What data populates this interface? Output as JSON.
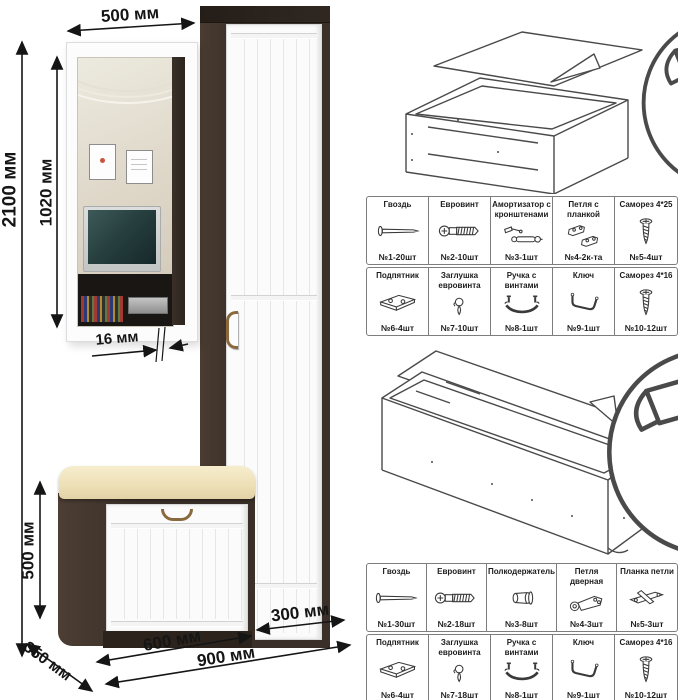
{
  "dimensions": {
    "total_height": "2100 мм",
    "mirror_width": "500 мм",
    "mirror_height": "1020 мм",
    "panel_thickness": "16 мм",
    "bench_height": "500 мм",
    "depth": "350 мм",
    "bench_width": "600 мм",
    "cabinet_width": "300 мм",
    "total_width": "900 мм"
  },
  "colors": {
    "wenge": "#3a3029",
    "cushion": "#eee1b8",
    "handle": "#8a6a3c",
    "arrow": "#151515"
  },
  "assembly": {
    "steps": [
      {
        "name": "attach-back-panel-bench",
        "tool_icon": "hammer-icon",
        "fastener_icon": "nail-icon"
      },
      {
        "name": "attach-back-panel-cabinet",
        "tool_icon": "hammer-icon",
        "fastener_icon": "nail-icon"
      }
    ]
  },
  "hardware_tables": [
    {
      "cells": [
        {
          "name": "Гвоздь",
          "count": "№1-20шт",
          "icon": "nail-icon"
        },
        {
          "name": "Евровинт",
          "count": "№2-10шт",
          "icon": "euroscrew-icon"
        },
        {
          "name": "Амортизатор с кронштенами",
          "count": "№3-1шт",
          "icon": "gas-lift-icon"
        },
        {
          "name": "Петля с планкой",
          "count": "№4-2к-та",
          "icon": "hinge-with-plate-icon"
        },
        {
          "name": "Саморез 4*25",
          "count": "№5-4шт",
          "icon": "screw-icon"
        },
        {
          "name": "Подпятник",
          "count": "№6-4шт",
          "icon": "footplate-icon"
        },
        {
          "name": "Заглушка евровинта",
          "count": "№7-10шт",
          "icon": "cap-icon"
        },
        {
          "name": "Ручка с винтами",
          "count": "№8-1шт",
          "icon": "handle-icon"
        },
        {
          "name": "Ключ",
          "count": "№9-1шт",
          "icon": "hexkey-icon"
        },
        {
          "name": "Саморез 4*16",
          "count": "№10-12шт",
          "icon": "screw-icon"
        }
      ]
    },
    {
      "cells": [
        {
          "name": "Гвоздь",
          "count": "№1-30шт",
          "icon": "nail-icon"
        },
        {
          "name": "Евровинт",
          "count": "№2-18шт",
          "icon": "euroscrew-icon"
        },
        {
          "name": "Полкодержатель",
          "count": "№3-8шт",
          "icon": "shelf-pin-icon"
        },
        {
          "name": "Петля дверная",
          "count": "№4-3шт",
          "icon": "door-hinge-icon"
        },
        {
          "name": "Планка петли",
          "count": "№5-3шт",
          "icon": "hinge-plate-icon"
        },
        {
          "name": "Подпятник",
          "count": "№6-4шт",
          "icon": "footplate-icon"
        },
        {
          "name": "Заглушка евровинта",
          "count": "№7-18шт",
          "icon": "cap-icon"
        },
        {
          "name": "Ручка с винтами",
          "count": "№8-1шт",
          "icon": "handle-icon"
        },
        {
          "name": "Ключ",
          "count": "№9-1шт",
          "icon": "hexkey-icon"
        },
        {
          "name": "Саморез 4*16",
          "count": "№10-12шт",
          "icon": "screw-icon"
        }
      ]
    }
  ]
}
